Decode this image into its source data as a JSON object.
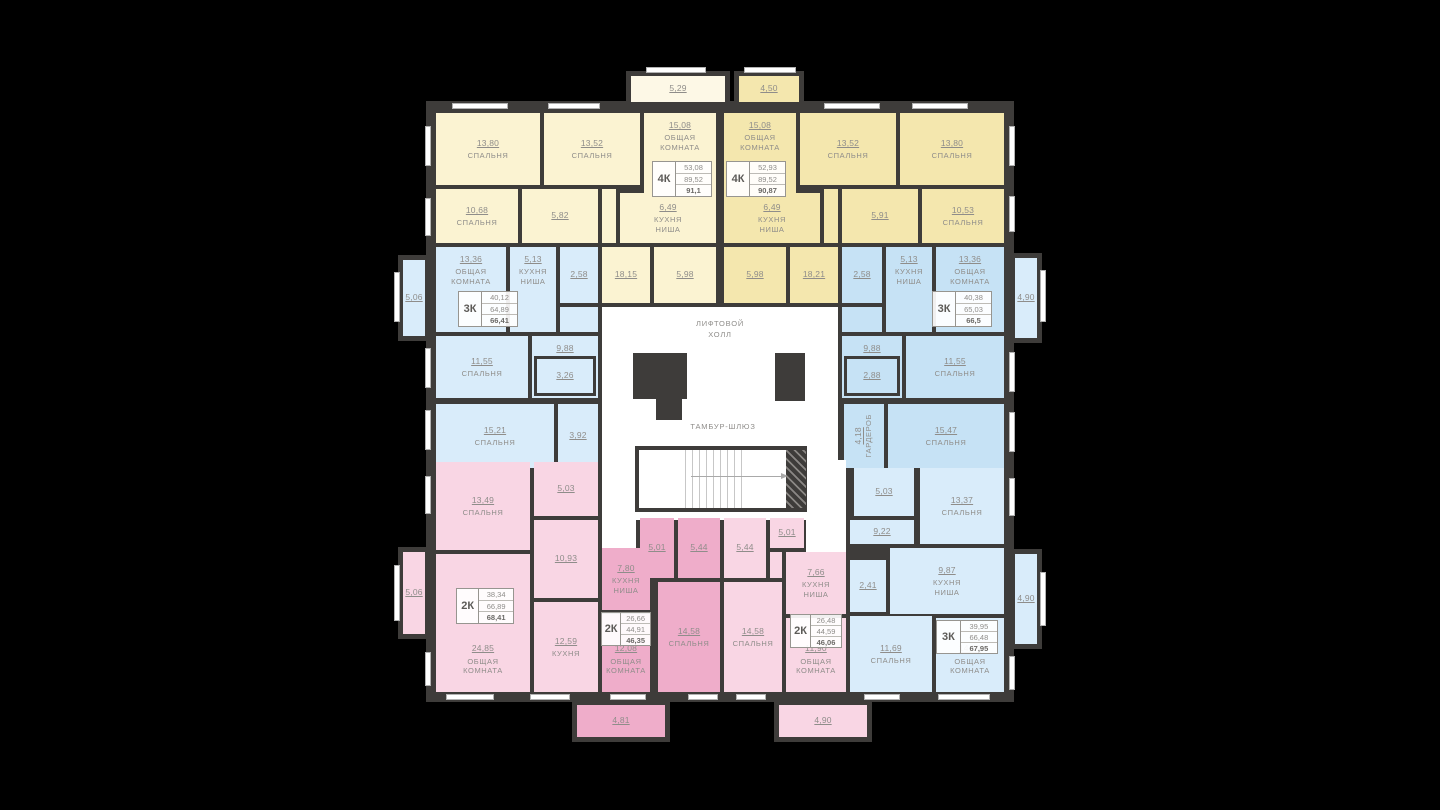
{
  "colors": {
    "wall": "#3e3c3a",
    "yl": "#fbf3d2",
    "ylt": "#fdf8e6",
    "yd": "#f4e7ae",
    "bl": "#d9ecfa",
    "bd": "#c6e2f5",
    "pl": "#f9d6e4",
    "pd": "#efadca",
    "wh": "#ffffff"
  },
  "underlay": {
    "x": 426,
    "y": 101,
    "w": 588,
    "h": 601
  },
  "core": {
    "lift_hall": "ЛИФТОВОЙ\nХОЛЛ",
    "tambour": "ТАМБУР-ШЛЮЗ",
    "stair": {
      "x": 635,
      "y": 446,
      "w": 172,
      "h": 66,
      "steps_left": 46,
      "steps_w": 60,
      "arrow_left": 52,
      "arrow_w": 96
    },
    "hatch": {
      "x": 786,
      "y": 450,
      "w": 20,
      "h": 58
    },
    "shafts": [
      {
        "x": 633,
        "y": 353,
        "w": 54,
        "h": 46
      },
      {
        "x": 656,
        "y": 398,
        "w": 26,
        "h": 22
      },
      {
        "x": 775,
        "y": 353,
        "w": 30,
        "h": 48
      }
    ]
  },
  "rooms": [
    {
      "x": 436,
      "y": 113,
      "w": 104,
      "h": 72,
      "f": "yl",
      "a": "13,80",
      "n": "СПАЛЬНЯ"
    },
    {
      "x": 544,
      "y": 113,
      "w": 96,
      "h": 72,
      "f": "yl",
      "a": "13,52",
      "n": "СПАЛЬНЯ"
    },
    {
      "x": 644,
      "y": 113,
      "w": 72,
      "h": 88,
      "f": "yl",
      "a": "15,08",
      "n": "ОБЩАЯ\nКОМНАТА",
      "lp": "top"
    },
    {
      "x": 436,
      "y": 189,
      "w": 82,
      "h": 54,
      "f": "yl",
      "a": "10,68",
      "n": "СПАЛЬНЯ"
    },
    {
      "x": 522,
      "y": 189,
      "w": 76,
      "h": 54,
      "f": "yl",
      "a": "5,82"
    },
    {
      "x": 602,
      "y": 189,
      "w": 14,
      "h": 54,
      "f": "yl"
    },
    {
      "x": 620,
      "y": 193,
      "w": 96,
      "h": 50,
      "f": "yl",
      "a": "6,49",
      "n": "КУХНЯ\nНИША"
    },
    {
      "x": 602,
      "y": 247,
      "w": 48,
      "h": 56,
      "f": "yl",
      "a": "18,15"
    },
    {
      "x": 654,
      "y": 247,
      "w": 62,
      "h": 56,
      "f": "yl",
      "a": "5,98"
    },
    {
      "x": 724,
      "y": 113,
      "w": 72,
      "h": 88,
      "f": "yd",
      "a": "15,08",
      "n": "ОБЩАЯ\nКОМНАТА",
      "lp": "top"
    },
    {
      "x": 800,
      "y": 113,
      "w": 96,
      "h": 72,
      "f": "yd",
      "a": "13,52",
      "n": "СПАЛЬНЯ"
    },
    {
      "x": 900,
      "y": 113,
      "w": 104,
      "h": 72,
      "f": "yd",
      "a": "13,80",
      "n": "СПАЛЬНЯ"
    },
    {
      "x": 724,
      "y": 193,
      "w": 96,
      "h": 50,
      "f": "yd",
      "a": "6,49",
      "n": "КУХНЯ\nНИША"
    },
    {
      "x": 824,
      "y": 189,
      "w": 14,
      "h": 54,
      "f": "yd"
    },
    {
      "x": 842,
      "y": 189,
      "w": 76,
      "h": 54,
      "f": "yd",
      "a": "5,91"
    },
    {
      "x": 922,
      "y": 189,
      "w": 82,
      "h": 54,
      "f": "yd",
      "a": "10,53",
      "n": "СПАЛЬНЯ"
    },
    {
      "x": 724,
      "y": 247,
      "w": 62,
      "h": 56,
      "f": "yd",
      "a": "5,98"
    },
    {
      "x": 790,
      "y": 247,
      "w": 48,
      "h": 56,
      "f": "yd",
      "a": "18,21"
    },
    {
      "x": 436,
      "y": 247,
      "w": 70,
      "h": 85,
      "f": "bl",
      "a": "13,36",
      "n": "ОБЩАЯ\nКОМНАТА",
      "lp": "top"
    },
    {
      "x": 510,
      "y": 247,
      "w": 46,
      "h": 85,
      "f": "bl",
      "a": "5,13",
      "n": "КУХНЯ\nНИША",
      "lp": "top"
    },
    {
      "x": 560,
      "y": 247,
      "w": 38,
      "h": 56,
      "f": "bl",
      "a": "2,58"
    },
    {
      "x": 560,
      "y": 307,
      "w": 38,
      "h": 25,
      "f": "bl"
    },
    {
      "x": 436,
      "y": 336,
      "w": 92,
      "h": 62,
      "f": "bl",
      "a": "11,55",
      "n": "СПАЛЬНЯ"
    },
    {
      "x": 532,
      "y": 336,
      "w": 66,
      "h": 62,
      "f": "bl",
      "a": "9,88",
      "lp": "top"
    },
    {
      "x": 534,
      "y": 356,
      "w": 62,
      "h": 40,
      "f": "bl",
      "a": "3,26",
      "br": true
    },
    {
      "x": 436,
      "y": 404,
      "w": 118,
      "h": 64,
      "f": "bl",
      "a": "15,21",
      "n": "СПАЛЬНЯ"
    },
    {
      "x": 558,
      "y": 404,
      "w": 40,
      "h": 64,
      "f": "bl",
      "a": "3,92"
    },
    {
      "x": 842,
      "y": 247,
      "w": 40,
      "h": 56,
      "f": "bd",
      "a": "2,58"
    },
    {
      "x": 886,
      "y": 247,
      "w": 46,
      "h": 85,
      "f": "bd",
      "a": "5,13",
      "n": "КУХНЯ\nНИША",
      "lp": "top"
    },
    {
      "x": 936,
      "y": 247,
      "w": 68,
      "h": 85,
      "f": "bd",
      "a": "13,36",
      "n": "ОБЩАЯ\nКОМНАТА",
      "lp": "top"
    },
    {
      "x": 842,
      "y": 307,
      "w": 40,
      "h": 25,
      "f": "bd"
    },
    {
      "x": 842,
      "y": 336,
      "w": 60,
      "h": 62,
      "f": "bd",
      "a": "9,88",
      "lp": "top"
    },
    {
      "x": 844,
      "y": 356,
      "w": 56,
      "h": 40,
      "f": "bd",
      "a": "2,88",
      "br": true
    },
    {
      "x": 906,
      "y": 336,
      "w": 98,
      "h": 62,
      "f": "bd",
      "a": "11,55",
      "n": "СПАЛЬНЯ"
    },
    {
      "x": 844,
      "y": 404,
      "w": 40,
      "h": 64,
      "f": "bd",
      "a": "4,18",
      "n": "ГАРДЕРОБ",
      "vert": true
    },
    {
      "x": 888,
      "y": 404,
      "w": 116,
      "h": 64,
      "f": "bd",
      "a": "15,47",
      "n": "СПАЛЬНЯ"
    },
    {
      "x": 602,
      "y": 307,
      "w": 236,
      "h": 213,
      "f": "wh"
    },
    {
      "x": 602,
      "y": 520,
      "w": 34,
      "h": 36,
      "f": "wh"
    },
    {
      "x": 810,
      "y": 460,
      "w": 36,
      "h": 62,
      "f": "wh"
    },
    {
      "x": 806,
      "y": 520,
      "w": 40,
      "h": 34,
      "f": "wh"
    },
    {
      "x": 436,
      "y": 462,
      "w": 94,
      "h": 88,
      "f": "pl",
      "a": "13,49",
      "n": "СПАЛЬНЯ"
    },
    {
      "x": 534,
      "y": 462,
      "w": 64,
      "h": 54,
      "f": "pl",
      "a": "5,03"
    },
    {
      "x": 534,
      "y": 520,
      "w": 64,
      "h": 78,
      "f": "pl",
      "a": "10,93"
    },
    {
      "x": 436,
      "y": 554,
      "w": 94,
      "h": 138,
      "f": "pl",
      "a": "24,85",
      "n": "ОБЩАЯ\nКОМНАТА",
      "lp": "low"
    },
    {
      "x": 534,
      "y": 602,
      "w": 64,
      "h": 90,
      "f": "pl",
      "a": "12,59",
      "n": "КУХНЯ"
    },
    {
      "x": 602,
      "y": 548,
      "w": 48,
      "h": 62,
      "f": "pd",
      "a": "7,80",
      "n": "КУХНЯ\nНИША"
    },
    {
      "x": 602,
      "y": 614,
      "w": 48,
      "h": 78,
      "f": "pd",
      "a": "12,08",
      "n": "ОБЩАЯ\nКОМНАТА",
      "lp": "low"
    },
    {
      "x": 640,
      "y": 518,
      "w": 34,
      "h": 60,
      "f": "pd",
      "a": "5,01"
    },
    {
      "x": 678,
      "y": 518,
      "w": 42,
      "h": 60,
      "f": "pd",
      "a": "5,44"
    },
    {
      "x": 658,
      "y": 582,
      "w": 62,
      "h": 110,
      "f": "pd",
      "a": "14,58",
      "n": "СПАЛЬНЯ"
    },
    {
      "x": 724,
      "y": 518,
      "w": 42,
      "h": 60,
      "f": "pl",
      "a": "5,44"
    },
    {
      "x": 770,
      "y": 518,
      "w": 34,
      "h": 30,
      "f": "pl",
      "a": "5,01"
    },
    {
      "x": 770,
      "y": 552,
      "w": 12,
      "h": 26,
      "f": "pl"
    },
    {
      "x": 786,
      "y": 552,
      "w": 60,
      "h": 62,
      "f": "pl",
      "a": "7,66",
      "n": "КУХНЯ\nНИША"
    },
    {
      "x": 724,
      "y": 582,
      "w": 58,
      "h": 110,
      "f": "pl",
      "a": "14,58",
      "n": "СПАЛЬНЯ"
    },
    {
      "x": 786,
      "y": 618,
      "w": 60,
      "h": 74,
      "f": "pl",
      "a": "11,90",
      "n": "ОБЩАЯ\nКОМНАТА",
      "lp": "low"
    },
    {
      "x": 854,
      "y": 468,
      "w": 60,
      "h": 48,
      "f": "bl",
      "a": "5,03"
    },
    {
      "x": 920,
      "y": 468,
      "w": 84,
      "h": 76,
      "f": "bl",
      "a": "13,37",
      "n": "СПАЛЬНЯ"
    },
    {
      "x": 850,
      "y": 520,
      "w": 64,
      "h": 24,
      "f": "bl",
      "a": "9,22"
    },
    {
      "x": 850,
      "y": 560,
      "w": 36,
      "h": 52,
      "f": "bl",
      "a": "2,41"
    },
    {
      "x": 890,
      "y": 548,
      "w": 114,
      "h": 66,
      "f": "bl",
      "a": "9,87",
      "n": "КУХНЯ\nНИША"
    },
    {
      "x": 850,
      "y": 616,
      "w": 82,
      "h": 76,
      "f": "bl",
      "a": "11,69",
      "n": "СПАЛЬНЯ"
    },
    {
      "x": 936,
      "y": 618,
      "w": 68,
      "h": 74,
      "f": "bl",
      "a": "14,89",
      "n": "ОБЩАЯ\nКОМНАТА",
      "lp": "low"
    }
  ],
  "balconies": [
    {
      "x": 626,
      "y": 71,
      "w": 104,
      "h": 36,
      "f": "ylt",
      "a": "5,29"
    },
    {
      "x": 734,
      "y": 71,
      "w": 70,
      "h": 36,
      "f": "yd",
      "a": "4,50"
    },
    {
      "x": 398,
      "y": 255,
      "w": 32,
      "h": 86,
      "f": "bl",
      "a": "5,06"
    },
    {
      "x": 398,
      "y": 547,
      "w": 32,
      "h": 92,
      "f": "pl",
      "a": "5,06"
    },
    {
      "x": 1010,
      "y": 253,
      "w": 32,
      "h": 90,
      "f": "bl",
      "a": "4,90"
    },
    {
      "x": 1010,
      "y": 549,
      "w": 32,
      "h": 100,
      "f": "bl",
      "a": "4,90"
    },
    {
      "x": 572,
      "y": 700,
      "w": 98,
      "h": 42,
      "f": "pd",
      "a": "4,81"
    },
    {
      "x": 774,
      "y": 700,
      "w": 98,
      "h": 42,
      "f": "pl",
      "a": "4,90"
    }
  ],
  "tables": [
    {
      "type": "4К",
      "rows": [
        "53,08",
        "89,52",
        "91,1"
      ],
      "x": 652,
      "y": 161,
      "w": 60,
      "h": 36
    },
    {
      "type": "4К",
      "rows": [
        "52,93",
        "89,52",
        "90,87"
      ],
      "x": 726,
      "y": 161,
      "w": 60,
      "h": 36
    },
    {
      "type": "3К",
      "rows": [
        "40,12",
        "64,89",
        "66,41"
      ],
      "x": 458,
      "y": 291,
      "w": 60,
      "h": 36
    },
    {
      "type": "3К",
      "rows": [
        "40,38",
        "65,03",
        "66,5"
      ],
      "x": 932,
      "y": 291,
      "w": 60,
      "h": 36
    },
    {
      "type": "2К",
      "rows": [
        "38,34",
        "66,89",
        "68,41"
      ],
      "x": 456,
      "y": 588,
      "w": 58,
      "h": 36
    },
    {
      "type": "2К",
      "rows": [
        "26,66",
        "44,91",
        "46,35"
      ],
      "x": 601,
      "y": 612,
      "w": 50,
      "h": 34
    },
    {
      "type": "2К",
      "rows": [
        "26,48",
        "44,59",
        "46,06"
      ],
      "x": 790,
      "y": 614,
      "w": 52,
      "h": 34
    },
    {
      "type": "3К",
      "rows": [
        "39,95",
        "66,48",
        "67,95"
      ],
      "x": 936,
      "y": 620,
      "w": 62,
      "h": 34
    }
  ],
  "windows": [
    {
      "x": 452,
      "y": 103,
      "w": 56,
      "h": 6
    },
    {
      "x": 548,
      "y": 103,
      "w": 52,
      "h": 6
    },
    {
      "x": 824,
      "y": 103,
      "w": 56,
      "h": 6
    },
    {
      "x": 912,
      "y": 103,
      "w": 56,
      "h": 6
    },
    {
      "x": 646,
      "y": 67,
      "w": 60,
      "h": 6
    },
    {
      "x": 744,
      "y": 67,
      "w": 52,
      "h": 6
    },
    {
      "x": 425,
      "y": 126,
      "w": 6,
      "h": 40
    },
    {
      "x": 425,
      "y": 198,
      "w": 6,
      "h": 38
    },
    {
      "x": 425,
      "y": 348,
      "w": 6,
      "h": 40
    },
    {
      "x": 425,
      "y": 410,
      "w": 6,
      "h": 40
    },
    {
      "x": 425,
      "y": 476,
      "w": 6,
      "h": 38
    },
    {
      "x": 425,
      "y": 652,
      "w": 6,
      "h": 34
    },
    {
      "x": 394,
      "y": 272,
      "w": 6,
      "h": 50
    },
    {
      "x": 394,
      "y": 565,
      "w": 6,
      "h": 56
    },
    {
      "x": 1009,
      "y": 126,
      "w": 6,
      "h": 40
    },
    {
      "x": 1009,
      "y": 196,
      "w": 6,
      "h": 36
    },
    {
      "x": 1009,
      "y": 352,
      "w": 6,
      "h": 40
    },
    {
      "x": 1009,
      "y": 412,
      "w": 6,
      "h": 40
    },
    {
      "x": 1009,
      "y": 478,
      "w": 6,
      "h": 38
    },
    {
      "x": 1009,
      "y": 656,
      "w": 6,
      "h": 34
    },
    {
      "x": 1040,
      "y": 270,
      "w": 6,
      "h": 52
    },
    {
      "x": 1040,
      "y": 572,
      "w": 6,
      "h": 54
    },
    {
      "x": 446,
      "y": 694,
      "w": 48,
      "h": 6
    },
    {
      "x": 530,
      "y": 694,
      "w": 40,
      "h": 6
    },
    {
      "x": 610,
      "y": 694,
      "w": 36,
      "h": 6
    },
    {
      "x": 688,
      "y": 694,
      "w": 30,
      "h": 6
    },
    {
      "x": 736,
      "y": 694,
      "w": 30,
      "h": 6
    },
    {
      "x": 864,
      "y": 694,
      "w": 36,
      "h": 6
    },
    {
      "x": 938,
      "y": 694,
      "w": 52,
      "h": 6
    }
  ]
}
